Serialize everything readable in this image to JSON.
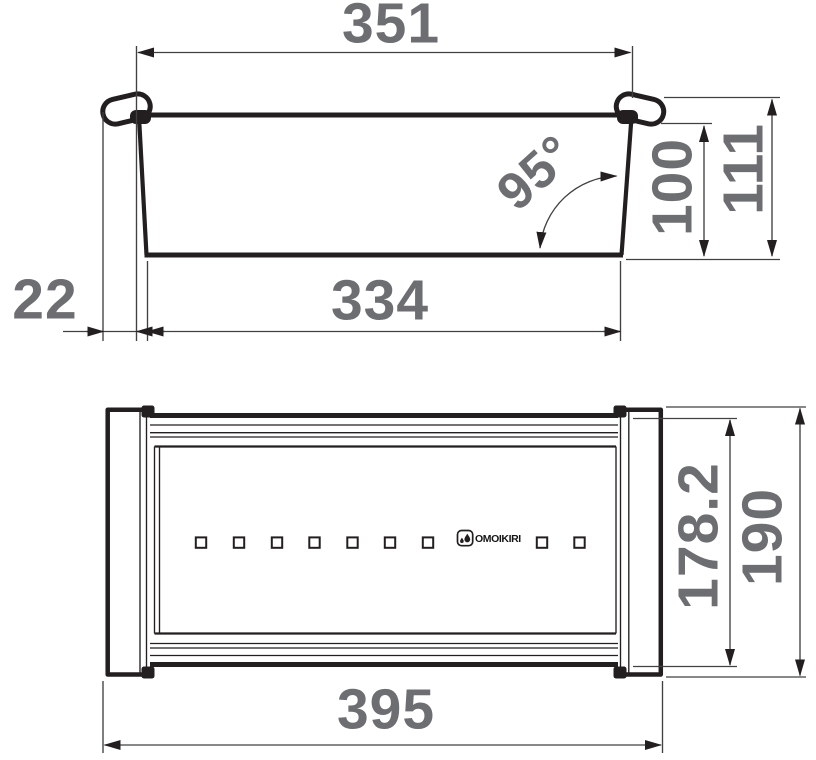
{
  "title": "Sink colander technical drawing",
  "colors": {
    "dim_text": "#6d6e71",
    "outline": "#231f20",
    "dim_line": "#414042",
    "background": "#ffffff"
  },
  "side_view": {
    "dims": {
      "top_width": "351",
      "overhang": "22",
      "bottom_width": "334",
      "wall_angle": "95°",
      "inner_height": "100",
      "overall_height": "111"
    }
  },
  "plan_view": {
    "dims": {
      "inner_depth": "178.2",
      "overall_depth": "190",
      "overall_width": "395"
    },
    "logo": "OMOIKIRI",
    "hole_count": 9
  }
}
